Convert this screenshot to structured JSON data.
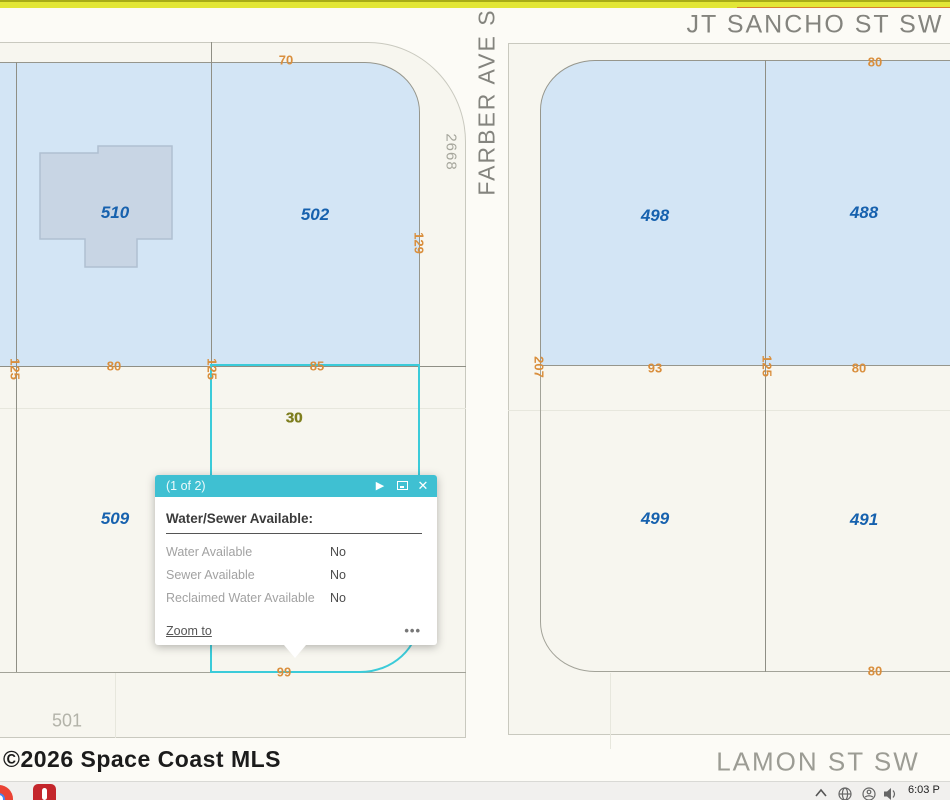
{
  "map": {
    "streets": {
      "jt_sancho": "JT SANCHO ST SW",
      "farber": "FARBER AVE S",
      "lamon": "LAMON ST SW"
    },
    "parcels": {
      "p510": "510",
      "p502": "502",
      "p498": "498",
      "p488": "488",
      "p509": "509",
      "p499": "499",
      "p491": "491"
    },
    "house_number": "2668",
    "block_number": "501",
    "selected_lot_label": "30",
    "dims": {
      "top_70": "70",
      "depth_129": "129",
      "west_125": "125",
      "width_80": "80",
      "sel_125": "125",
      "sel_85": "85",
      "sel_99": "99",
      "east_207": "207",
      "width_93": "93",
      "mid_125": "125",
      "width_80b": "80",
      "top_80": "80",
      "bottom_80": "80"
    }
  },
  "popup": {
    "header": "(1 of 2)",
    "next_icon": "▶",
    "close_icon": "✕",
    "title": "Water/Sewer Available:",
    "rows": [
      {
        "label": "Water Available",
        "value": "No"
      },
      {
        "label": "Sewer Available",
        "value": "No"
      },
      {
        "label": "Reclaimed Water Available",
        "value": "No"
      }
    ],
    "zoom_to": "Zoom to",
    "more": "•••"
  },
  "watermark": "©2026 Space Coast MLS",
  "taskbar": {
    "time": "6:03 P"
  },
  "colors": {
    "selection": "#3bcbd9",
    "popup_header": "#3fc0d2",
    "dimension": "#d98e3c",
    "parcel_fill": "#d3e5f5",
    "parcel_label": "#1661ae",
    "topbar_yellow": "#e2e636",
    "lot_label_olive": "#7d7d1f"
  }
}
